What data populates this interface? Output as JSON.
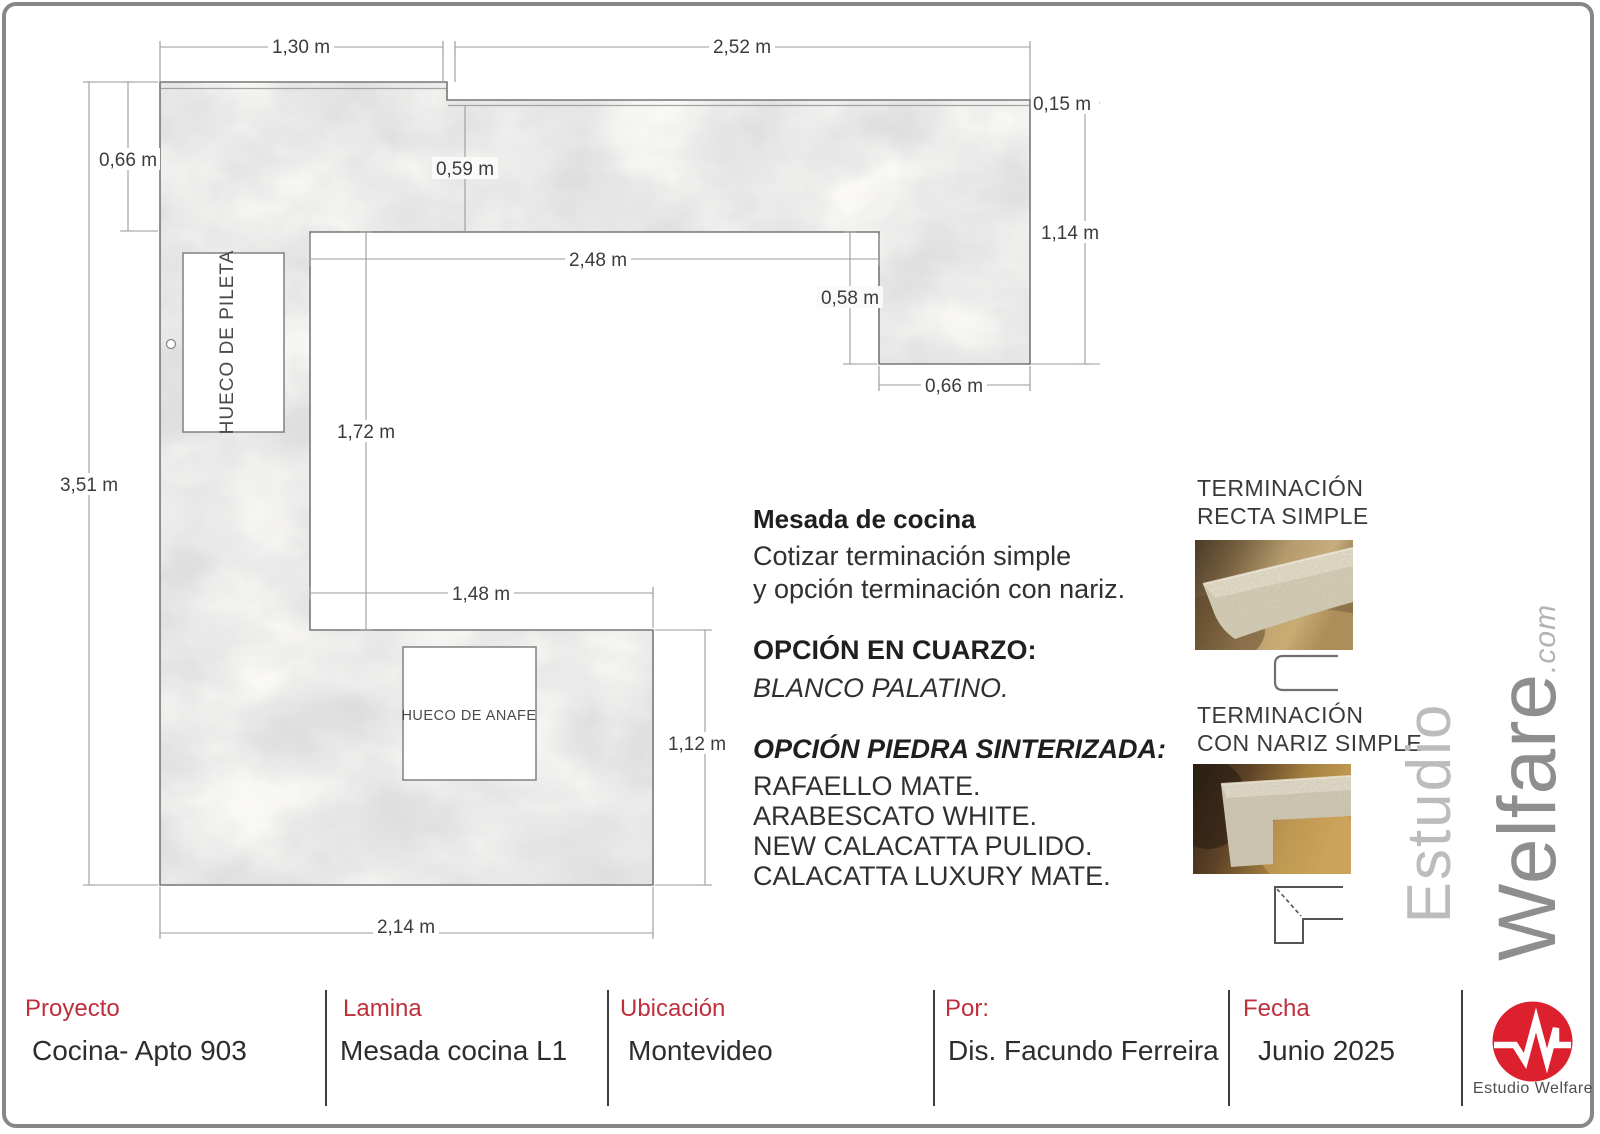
{
  "plan": {
    "dims": {
      "d130": "1,30 m",
      "d252": "2,52 m",
      "d015": "0,15 m",
      "d066l": "0,66 m",
      "d059": "0,59 m",
      "d114": "1,14 m",
      "d248": "2,48 m",
      "d058": "0,58 m",
      "d066r": "0,66 m",
      "d172": "1,72 m",
      "d351": "3,51 m",
      "d148": "1,48 m",
      "d112": "1,12 m",
      "d214": "2,14 m"
    },
    "labels": {
      "sink": "HUECO DE PILETA",
      "cooktop": "HUECO DE ANAFE"
    }
  },
  "notes": {
    "title": "Mesada de cocina",
    "line1": "Cotizar terminación simple",
    "line2": "y opción terminación con nariz.",
    "quartz_heading": "OPCIÓN EN CUARZO:",
    "quartz_option": "BLANCO PALATINO.",
    "sintered_heading": "OPCIÓN PIEDRA SINTERIZADA:",
    "sintered_options": [
      "RAFAELLO MATE.",
      "ARABESCATO WHITE.",
      "NEW CALACATTA PULIDO.",
      "CALACATTA LUXURY MATE."
    ]
  },
  "terminations": {
    "first": {
      "line1": "TERMINACIÓN",
      "line2": "RECTA SIMPLE"
    },
    "second": {
      "line1": "TERMINACIÓN",
      "line2": "CON NARIZ SIMPLE"
    }
  },
  "watermark": {
    "studio": "Estudio",
    "name": "Welfare",
    "tld": ".com"
  },
  "titleblock": {
    "fields": [
      {
        "label": "Proyecto",
        "value": "Cocina- Apto 903"
      },
      {
        "label": "Lamina",
        "value": "Mesada cocina L1"
      },
      {
        "label": "Ubicación",
        "value": "Montevideo"
      },
      {
        "label": "Por:",
        "value": "Dis. Facundo Ferreira"
      },
      {
        "label": "Fecha",
        "value": "Junio 2025"
      }
    ],
    "logo_text": "Estudio Welfare"
  },
  "colors": {
    "accent_red": "#bf2f3c",
    "logo_red": "#dc202e",
    "dim_text": "#3c3c3c",
    "dim_line": "#9b9b9b",
    "outline": "#767676"
  }
}
